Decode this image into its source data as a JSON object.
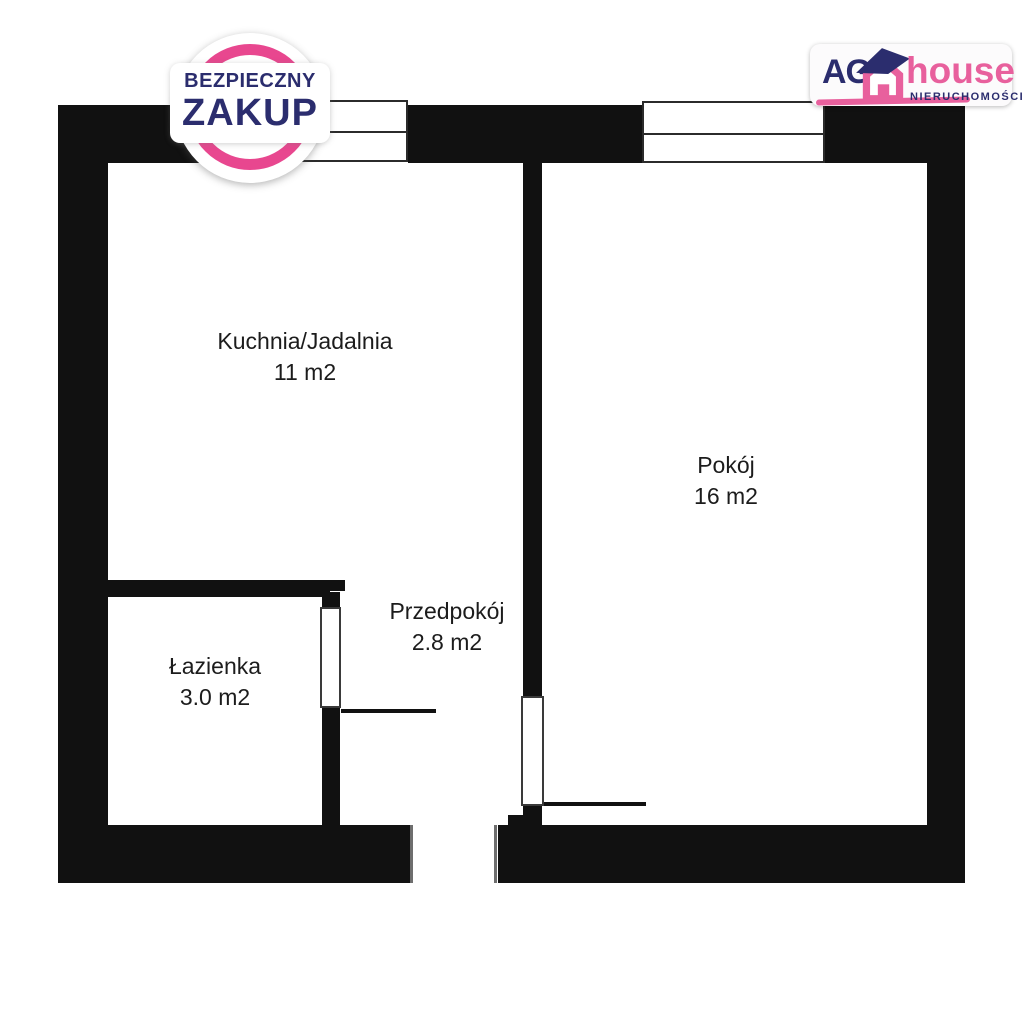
{
  "badge": {
    "line1": "BEZPIECZNY",
    "line2": "ZAKUP",
    "ring_color": "#e8478f",
    "text_color": "#2b2d6e"
  },
  "logo": {
    "prefix": "AG",
    "name": "house",
    "subtitle": "NIERUCHOMOŚCI",
    "icon": "house-icon",
    "navy": "#2b2d6e",
    "pink": "#e8609d"
  },
  "floorplan": {
    "wall_color": "#111111",
    "rooms": [
      {
        "name": "Kuchnia/Jadalnia",
        "area": "11 m2"
      },
      {
        "name": "Pokój",
        "area": "16 m2"
      },
      {
        "name": "Przedpokój",
        "area": "2.8 m2"
      },
      {
        "name": "Łazienka",
        "area": "3.0 m2"
      }
    ]
  }
}
